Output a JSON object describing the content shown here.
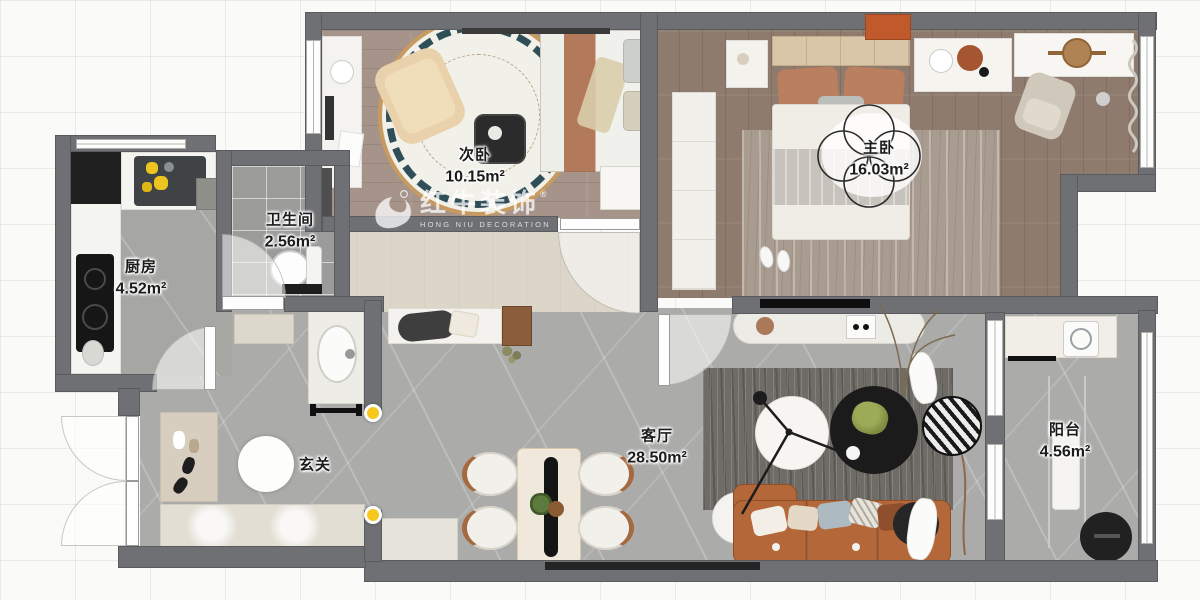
{
  "watermark": {
    "brand": "红牛装饰",
    "subtitle": "HONG NIU DECORATION",
    "registered": "®"
  },
  "rooms": [
    {
      "name": "次卧",
      "area": "10.15m²"
    },
    {
      "name": "主卧",
      "area": "16.03m²"
    },
    {
      "name": "卫生间",
      "area": "2.56m²"
    },
    {
      "name": "厨房",
      "area": "4.52m²"
    },
    {
      "name": "玄关",
      "area": ""
    },
    {
      "name": "客厅",
      "area": "28.50m²"
    },
    {
      "name": "阳台",
      "area": "4.56m²"
    }
  ],
  "colors": {
    "wall": "#6E7073",
    "marbleFloor": "#ABABA9",
    "woodSecondBedroom": "#A6948A",
    "woodMasterBedroom": "#8E7B6E",
    "hallwayFloor": "#DCD6C9",
    "bathroomTile": "#9B9B99",
    "sofaOrange": "#B4683A",
    "accentOrange": "#C05A2C",
    "markerYellow": "#F7C71C",
    "rugDark": "#6F6C67",
    "watermarkWhite": "rgba(255,255,255,0.75)"
  }
}
